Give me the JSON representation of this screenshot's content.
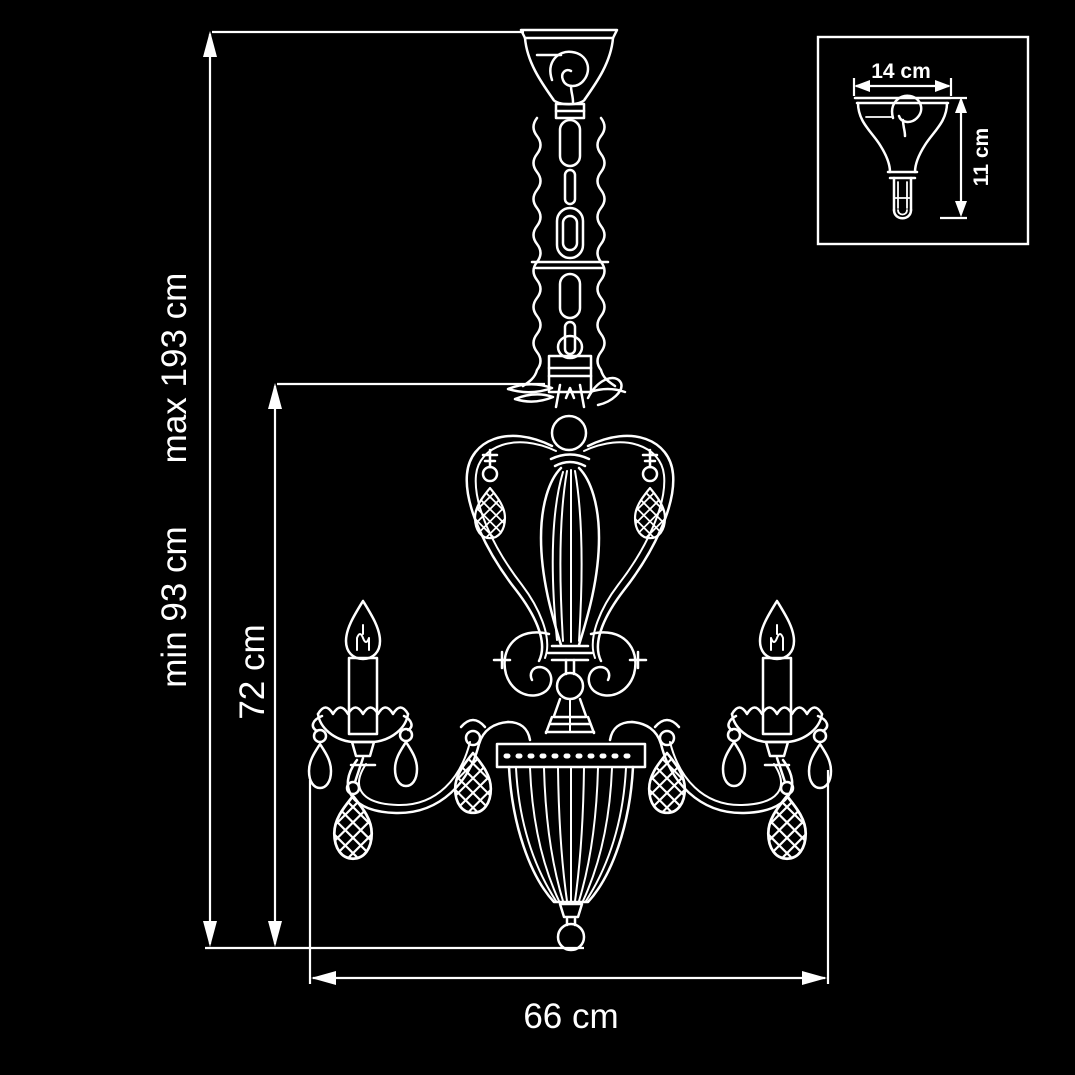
{
  "colors": {
    "background": "#000000",
    "line": "#ffffff"
  },
  "drawing": {
    "overall_height": {
      "min_label": "min 93 cm",
      "max_label": "max 193 cm"
    },
    "body_height_label": "72 cm",
    "width_label": "66 cm",
    "inset": {
      "width_label": "14 cm",
      "height_label": "11 cm"
    }
  }
}
